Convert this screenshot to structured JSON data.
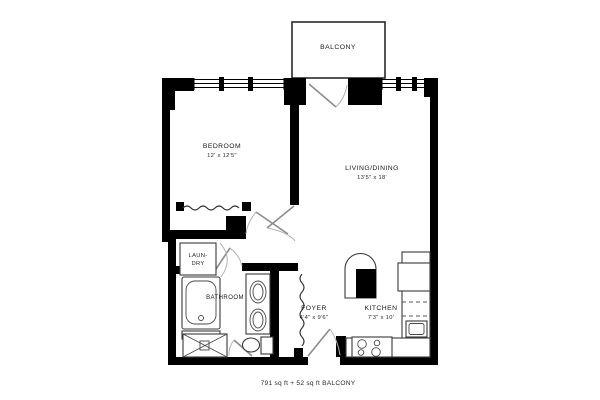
{
  "plan": {
    "caption": "791 sq ft + 52 sq ft BALCONY",
    "rooms": {
      "balcony": {
        "name": "BALCONY"
      },
      "bedroom": {
        "name": "BEDROOM",
        "dims": "12' x 12'5\""
      },
      "living": {
        "name": "LIVING/DINING",
        "dims": "13'5\" x 18'"
      },
      "bathroom": {
        "name": "BATHROOM"
      },
      "laundry": {
        "name_line1": "LAUN-",
        "name_line2": "DRY"
      },
      "foyer": {
        "name": "FOYER",
        "dims": "4'4\" x 9'6\""
      },
      "kitchen": {
        "name": "KITCHEN",
        "dims": "7'3\" x 10'"
      }
    },
    "colors": {
      "wall": "#000000",
      "door": "#8c8c8c",
      "fixture": "#3a3a3a",
      "background": "#ffffff"
    }
  }
}
